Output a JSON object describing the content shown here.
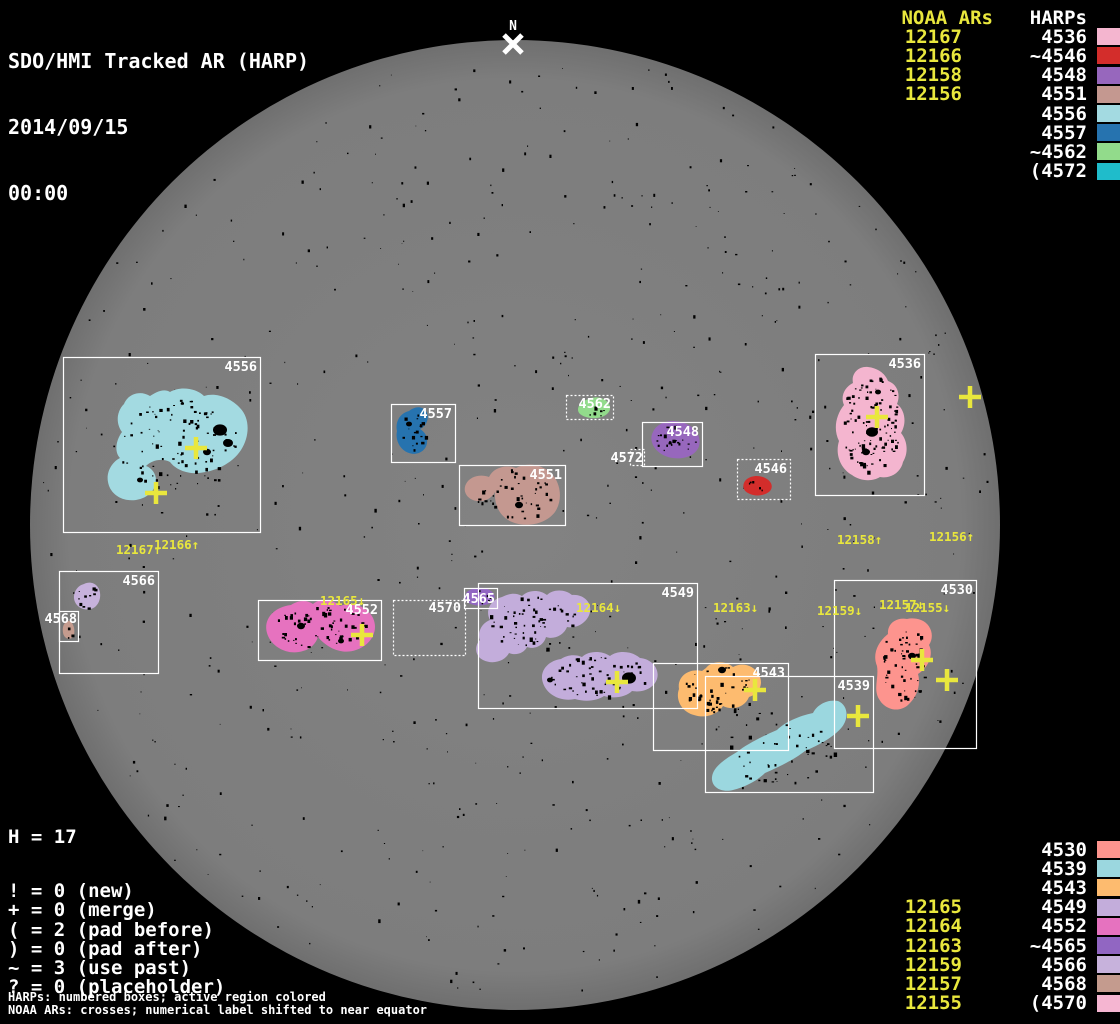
{
  "header": {
    "title": "SDO/HMI Tracked AR (HARP)",
    "date": "2014/09/15",
    "time": "00:00"
  },
  "colors": {
    "background": "#000000",
    "disk": "#7d7d7d",
    "disk_limb": "#6f6f6f",
    "box_stroke": "#ffffff",
    "noaa_yellow": "#e9e73d",
    "text_white": "#ffffff",
    "speckle": "#000000"
  },
  "legend_top": {
    "noaa_header": "NOAA ARs",
    "harp_header": "HARPs",
    "rows": [
      {
        "noaa": "12167",
        "harp": "4536",
        "color": "#f4b5cf"
      },
      {
        "noaa": "12166",
        "harp": "~4546",
        "color": "#d32d2b"
      },
      {
        "noaa": "12158",
        "harp": "4548",
        "color": "#9767bd"
      },
      {
        "noaa": "12156",
        "harp": "4551",
        "color": "#c49890"
      },
      {
        "noaa": "",
        "harp": "4556",
        "color": "#a3dae1"
      },
      {
        "noaa": "",
        "harp": "4557",
        "color": "#2673af"
      },
      {
        "noaa": "",
        "harp": "~4562",
        "color": "#92db8b"
      },
      {
        "noaa": "",
        "harp": "(4572",
        "color": "#1fbccb"
      }
    ]
  },
  "legend_bottom": {
    "rows": [
      {
        "noaa": "",
        "harp": "4530",
        "color": "#fd948e"
      },
      {
        "noaa": "",
        "harp": "4539",
        "color": "#9bd7df"
      },
      {
        "noaa": "",
        "harp": "4543",
        "color": "#fdbb6f"
      },
      {
        "noaa": "12165",
        "harp": "4549",
        "color": "#c3addb"
      },
      {
        "noaa": "12164",
        "harp": "4552",
        "color": "#e672bf"
      },
      {
        "noaa": "12163",
        "harp": "~4565",
        "color": "#9166c2"
      },
      {
        "noaa": "12159",
        "harp": "4566",
        "color": "#c7b2dc"
      },
      {
        "noaa": "12157",
        "harp": "4568",
        "color": "#c49b8e"
      },
      {
        "noaa": "12155",
        "harp": "(4570",
        "color": "#f5b5d1"
      }
    ]
  },
  "stats": {
    "h_line": "H = 17",
    "lines": [
      "! = 0 (new)",
      "+ = 0 (merge)",
      "( = 2 (pad before)",
      ") = 0 (pad after)",
      "~ = 3 (use past)",
      "? = 0 (placeholder)"
    ]
  },
  "footnotes": [
    "HARPs: numbered boxes; active region colored",
    "NOAA ARs: crosses; numerical label shifted to near equator"
  ],
  "chart_data": {
    "type": "solar-disk-harp-map",
    "disk": {
      "cx": 515,
      "cy": 525,
      "r": 485
    },
    "north_marker": {
      "label": "N",
      "x": 513,
      "y": 30,
      "cross_x": 513,
      "cross_y": 44
    },
    "boxes": [
      {
        "harp": "4556",
        "x": 63,
        "y": 357,
        "w": 197,
        "h": 175,
        "style": "solid"
      },
      {
        "harp": "4557",
        "x": 391,
        "y": 404,
        "w": 64,
        "h": 58,
        "style": "solid"
      },
      {
        "harp": "4551",
        "x": 459,
        "y": 465,
        "w": 106,
        "h": 60,
        "style": "solid"
      },
      {
        "harp": "4562",
        "x": 566,
        "y": 395,
        "w": 47,
        "h": 24,
        "style": "dotted",
        "label_end": 611,
        "label_base": 408
      },
      {
        "harp": "4548",
        "x": 642,
        "y": 422,
        "w": 60,
        "h": 44,
        "style": "solid"
      },
      {
        "harp": "4572",
        "x": 630,
        "y": 449,
        "w": 14,
        "h": 16,
        "style": "dotted",
        "label_end": 643,
        "label_base": 462
      },
      {
        "harp": "4546",
        "x": 737,
        "y": 459,
        "w": 53,
        "h": 40,
        "style": "dotted"
      },
      {
        "harp": "4536",
        "x": 815,
        "y": 354,
        "w": 109,
        "h": 141,
        "style": "solid"
      },
      {
        "harp": "4566",
        "x": 59,
        "y": 571,
        "w": 99,
        "h": 102,
        "style": "solid"
      },
      {
        "harp": "4568",
        "x": 59,
        "y": 611,
        "w": 19,
        "h": 30,
        "style": "solid",
        "label_end": 77,
        "label_base": 623
      },
      {
        "harp": "4552",
        "x": 258,
        "y": 600,
        "w": 123,
        "h": 60,
        "style": "solid"
      },
      {
        "harp": "4570",
        "x": 393,
        "y": 600,
        "w": 72,
        "h": 55,
        "style": "dotted",
        "label_end": 461,
        "label_base": 612
      },
      {
        "harp": "4565",
        "x": 464,
        "y": 588,
        "w": 33,
        "h": 20,
        "style": "solid",
        "label_end": 495,
        "label_base": 603
      },
      {
        "harp": "4549",
        "x": 478,
        "y": 583,
        "w": 219,
        "h": 125,
        "style": "solid"
      },
      {
        "harp": "4543",
        "x": 653,
        "y": 663,
        "w": 135,
        "h": 87,
        "style": "solid"
      },
      {
        "harp": "4539",
        "x": 705,
        "y": 676,
        "w": 168,
        "h": 116,
        "style": "solid"
      },
      {
        "harp": "4530",
        "x": 834,
        "y": 580,
        "w": 142,
        "h": 168,
        "style": "solid"
      }
    ],
    "blobs": [
      {
        "harp": "4556",
        "color": "#a3dae1",
        "speckles": 95,
        "d": "M150,396 C140,390 128,394 124,404 C116,412 116,424 122,432 C116,440 114,452 120,458 C112,462 106,472 108,482 C110,494 122,502 136,500 C148,498 156,490 156,480 C156,474 152,468 146,466 C152,460 162,458 170,462 C176,470 188,474 198,473 C214,472 232,464 241,450 C250,436 250,418 240,408 C231,398 216,392 204,396 C196,388 180,386 170,392 C164,388 156,392 150,396 Z"
      },
      {
        "harp": "4557",
        "color": "#2673af",
        "speckles": 18,
        "d": "M409,411 C400,413 395,422 397,431 C395,440 400,450 409,453 C417,456 426,451 427,443 C428,437 425,432 420,429 C427,426 430,417 426,411 C421,405 414,407 409,411 Z"
      },
      {
        "harp": "4551",
        "color": "#c49890",
        "speckles": 42,
        "d": "M516,468 C505,464 493,468 489,477 C481,474 470,476 466,484 C462,492 468,500 477,501 C485,502 492,498 495,492 C494,505 500,517 512,522 C527,528 546,524 555,512 C563,500 561,483 551,473 C541,464 527,462 516,468 Z"
      },
      {
        "harp": "4562",
        "color": "#92db8b",
        "speckles": 7,
        "d": "M589,399 C580,401 575,409 580,414 C586,419 600,420 607,414 C613,409 610,401 601,398 C597,397 592,397 589,399 Z"
      },
      {
        "harp": "4548",
        "color": "#9767bd",
        "speckles": 22,
        "d": "M653,432 C648,441 655,453 668,457 C682,461 696,456 699,446 C702,436 694,425 681,422 C669,419 657,423 653,432 Z"
      },
      {
        "harp": "4546",
        "color": "#d32d2b",
        "speckles": 5,
        "d": "M747,479 C742,483 742,490 748,493 C755,497 765,496 770,491 C774,486 771,480 763,477 C757,475 751,476 747,479 Z"
      },
      {
        "harp": "4536",
        "color": "#f4b5cf",
        "speckles": 110,
        "d": "M868,367 C858,366 851,374 853,383 C845,387 840,396 844,405 C836,415 833,429 839,441 C835,454 840,468 852,475 C860,481 872,482 880,477 C891,479 901,472 903,462 C909,452 907,440 901,433 C907,423 905,410 897,404 C901,394 897,384 888,381 C885,373 877,368 868,367 Z"
      },
      {
        "harp": "4566",
        "color": "#c7b2dc",
        "speckles": 10,
        "d": "M84,584 C76,586 72,595 75,602 C78,609 88,612 95,607 C101,602 102,592 97,586 C93,582 88,582 84,584 Z"
      },
      {
        "harp": "4568",
        "color": "#c49b8e",
        "speckles": 3,
        "d": "M65,623 C62,626 62,634 65,637 C68,640 73,639 74,635 C75,630 74,625 71,622 C69,620 66,621 65,623 Z"
      },
      {
        "harp": "4552",
        "color": "#e672bf",
        "speckles": 65,
        "d": "M291,605 C274,607 263,619 267,633 C271,647 288,656 303,651 C311,649 316,643 318,637 C327,648 342,655 356,650 C371,645 379,631 373,618 C367,606 352,601 340,606 C333,599 320,598 313,604 C306,599 297,601 291,605 Z"
      },
      {
        "harp": "4565",
        "color": "#9166c2",
        "speckles": 5,
        "d": "M470,590 C464,593 463,600 469,603 C476,607 488,606 493,601 C497,596 493,590 484,588 C479,587 474,588 470,590 Z"
      },
      {
        "harp": "4549",
        "color": "#c3addb",
        "speckles": 60,
        "d": "M502,597 C490,600 485,611 490,620 C482,623 477,632 480,640 C474,646 475,656 483,660 C493,665 505,661 509,653 C516,656 524,653 527,647 C535,650 544,645 546,637 C554,640 564,635 567,627 C577,629 588,622 590,612 C592,602 583,594 572,595 C565,589 553,589 547,595 C539,589 528,590 522,596 C515,592 508,594 502,597 Z"
      },
      {
        "harp": "4549",
        "color": "#c3addb",
        "speckles": 55,
        "d": "M561,659 C547,661 539,672 543,683 C547,695 561,702 575,699 C585,702 597,701 604,696 C614,699 626,697 632,691 C643,693 654,688 657,679 C660,669 652,659 640,658 C632,651 618,650 610,656 C601,650 588,651 582,657 C575,654 567,655 561,659 Z"
      },
      {
        "harp": "4543",
        "color": "#fdbb6f",
        "speckles": 50,
        "d": "M702,671 C688,668 677,677 679,689 C675,700 682,712 694,715 C706,719 718,714 723,706 C733,711 745,707 749,697 C759,694 764,684 759,675 C754,665 742,662 733,667 C725,660 711,661 706,668 L702,671 Z"
      },
      {
        "harp": "4539",
        "color": "#9bd7df",
        "speckles": 48,
        "d": "M838,701 C827,699 817,705 813,713 C799,716 785,722 777,730 C763,736 747,744 737,752 C725,759 713,767 712,777 C711,787 721,793 733,790 C745,787 757,781 765,773 C779,767 795,759 805,751 C819,745 834,737 842,727 C849,718 848,705 838,701 Z"
      },
      {
        "harp": "4530",
        "color": "#fd948e",
        "speckles": 55,
        "d": "M907,619 C896,617 887,624 888,634 C878,642 872,654 877,666 C879,678 873,689 879,699 C885,710 899,713 908,705 C917,697 921,685 918,674 C928,668 934,655 929,645 C935,636 931,624 921,620 C916,618 911,618 907,619 Z"
      }
    ],
    "dark_dots": [
      {
        "x": 220,
        "y": 430,
        "r": 7
      },
      {
        "x": 228,
        "y": 443,
        "r": 5
      },
      {
        "x": 207,
        "y": 452,
        "r": 4
      },
      {
        "x": 872,
        "y": 432,
        "r": 6
      },
      {
        "x": 866,
        "y": 452,
        "r": 4
      },
      {
        "x": 878,
        "y": 392,
        "r": 3
      },
      {
        "x": 629,
        "y": 678,
        "r": 7
      },
      {
        "x": 722,
        "y": 670,
        "r": 4
      },
      {
        "x": 301,
        "y": 626,
        "r": 4
      },
      {
        "x": 341,
        "y": 641,
        "r": 3
      },
      {
        "x": 519,
        "y": 505,
        "r": 4
      },
      {
        "x": 409,
        "y": 424,
        "r": 3
      },
      {
        "x": 912,
        "y": 656,
        "r": 4
      },
      {
        "x": 550,
        "y": 680,
        "r": 3
      },
      {
        "x": 140,
        "y": 480,
        "r": 3
      }
    ],
    "noaa_labels": [
      {
        "text": "12167↑",
        "x": 116,
        "y": 554
      },
      {
        "text": "12166↑",
        "x": 154,
        "y": 549
      },
      {
        "text": "12158↑",
        "x": 837,
        "y": 544
      },
      {
        "text": "12156↑",
        "x": 929,
        "y": 541
      },
      {
        "text": "12165↓",
        "x": 320,
        "y": 605
      },
      {
        "text": "12164↓",
        "x": 576,
        "y": 612
      },
      {
        "text": "12163↓",
        "x": 713,
        "y": 612
      },
      {
        "text": "12159↓",
        "x": 817,
        "y": 615
      },
      {
        "text": "12157↓",
        "x": 879,
        "y": 609
      },
      {
        "text": "12155↓",
        "x": 905,
        "y": 612
      }
    ],
    "crosses": [
      {
        "x": 196,
        "y": 448
      },
      {
        "x": 156,
        "y": 493
      },
      {
        "x": 877,
        "y": 417
      },
      {
        "x": 970,
        "y": 397
      },
      {
        "x": 362,
        "y": 635
      },
      {
        "x": 617,
        "y": 682
      },
      {
        "x": 755,
        "y": 690
      },
      {
        "x": 858,
        "y": 716
      },
      {
        "x": 922,
        "y": 660
      },
      {
        "x": 947,
        "y": 680
      }
    ]
  }
}
